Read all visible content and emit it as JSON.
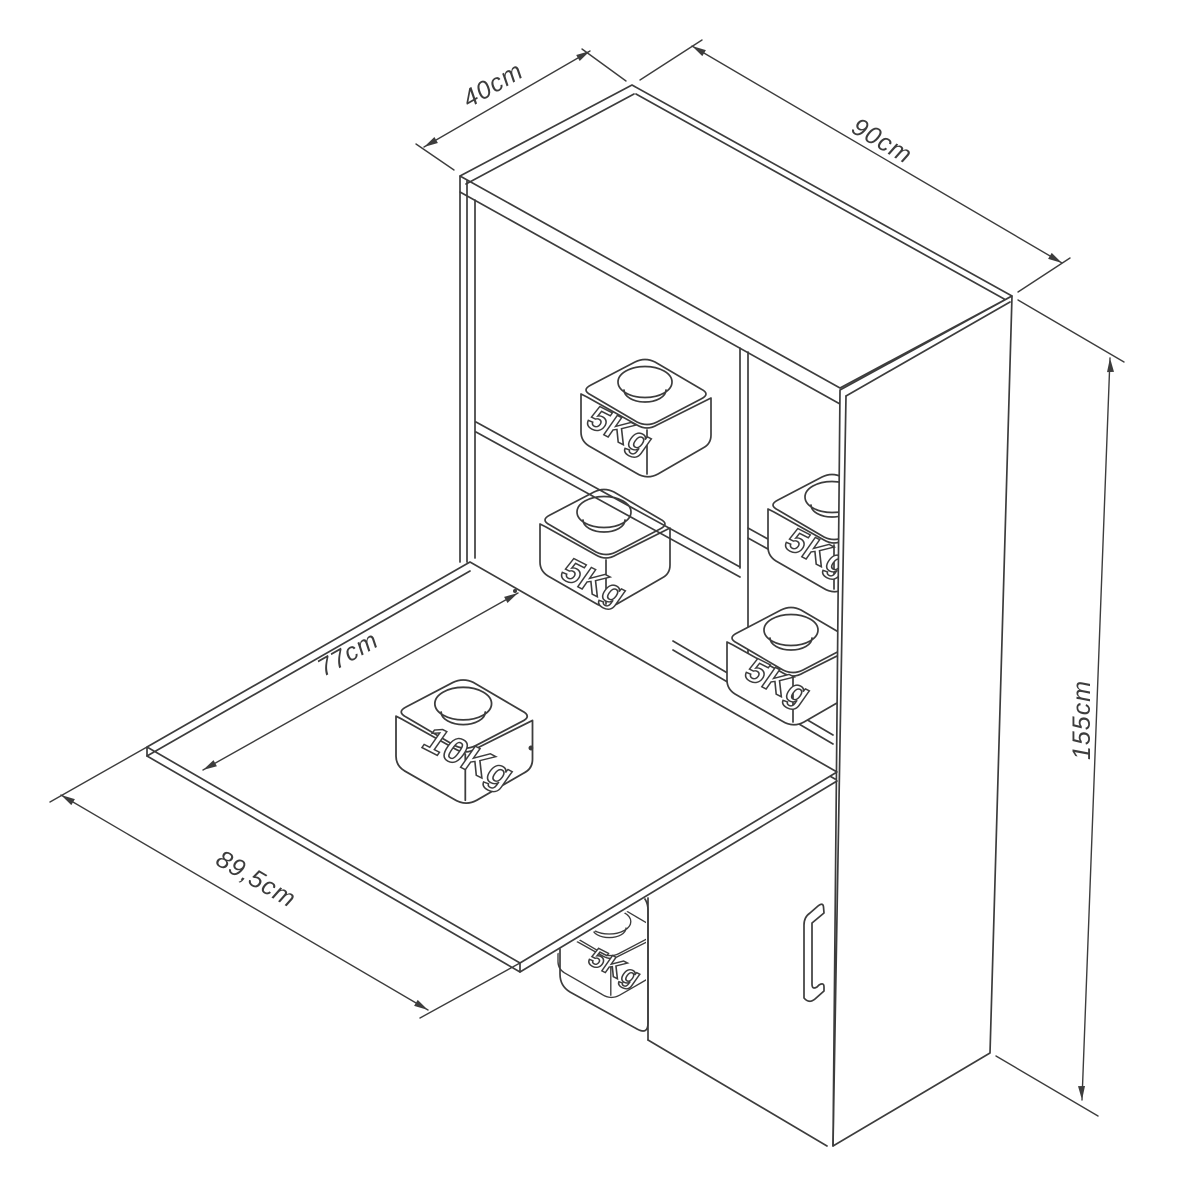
{
  "page": {
    "background": "#ffffff"
  },
  "drawing": {
    "line_color": "#3d3d3d",
    "dimensions": {
      "top_depth": "40cm",
      "top_width": "90cm",
      "overall_height": "155cm",
      "table_depth": "77cm",
      "table_width": "89,5cm"
    },
    "weights": {
      "shelf_weight": "5Kg",
      "table_weight": "10Kg"
    }
  }
}
